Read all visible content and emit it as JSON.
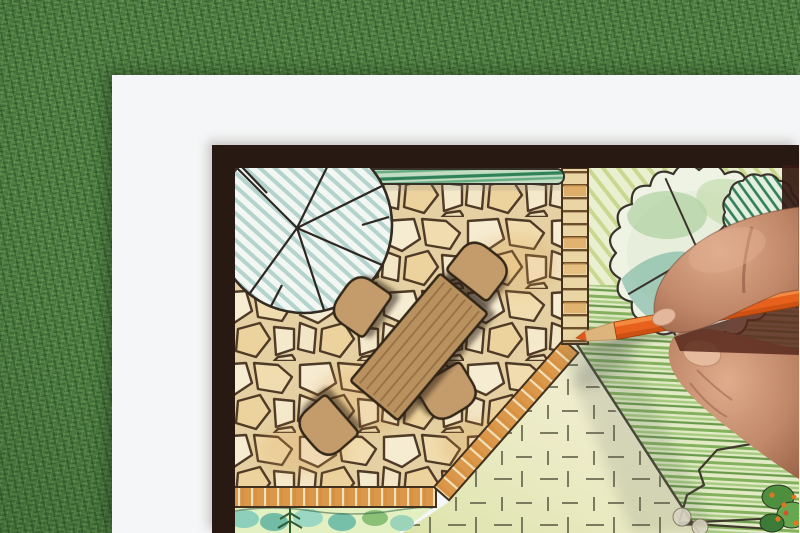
{
  "scene": {
    "labels": {
      "stage": "photo of a hand drawing a garden landscape design plan",
      "grass": "artificial grass lawn background",
      "paper": "white drawing paper sheet",
      "plan": "garden design plan drawing with dark frame",
      "frame": "dark plan border frame",
      "patio": "irregular flagstone patio paving",
      "table": "rectangular wooden dining table symbol",
      "chair": "rounded patio chair symbol",
      "tree_left": "large round tree canopy symbol with teal hatching",
      "tree_right": "scalloped tree canopy symbol with green wash",
      "bush": "hatched round shrub symbol",
      "hedge": "clipped green hedge strip",
      "brick_path": "brick garden path",
      "brick_edging": "brick patio edging",
      "dashed_lawn": "stippled dash-textured lawn area",
      "crayon_lawn": "green crayon shaded lawn",
      "planting_bed": "watercolor planting bed with conifer",
      "plants_corner": "flower bed with orange blooms",
      "hand": "designer's hand holding a pencil",
      "pencil": "orange colored pencil",
      "thumb_nail": "thumb nail",
      "index_nail": "index finger nail"
    },
    "colors": {
      "grass_green": "#4a7a3e",
      "paper_white": "#f5f6f7",
      "frame_dark": "#281a12",
      "stone_cream": "#f2e4c2",
      "stone_joint": "#4e3a26",
      "wood_tan": "#b9915e",
      "chair_tan": "#c49c6c",
      "brick_orange": "#d79140",
      "hedge_green": "#2f8257",
      "lawn_green": "#7fae57",
      "teal_wash": "#5aa391",
      "pencil_orange": "#e8611c",
      "skin_tone": "#c08868"
    }
  }
}
